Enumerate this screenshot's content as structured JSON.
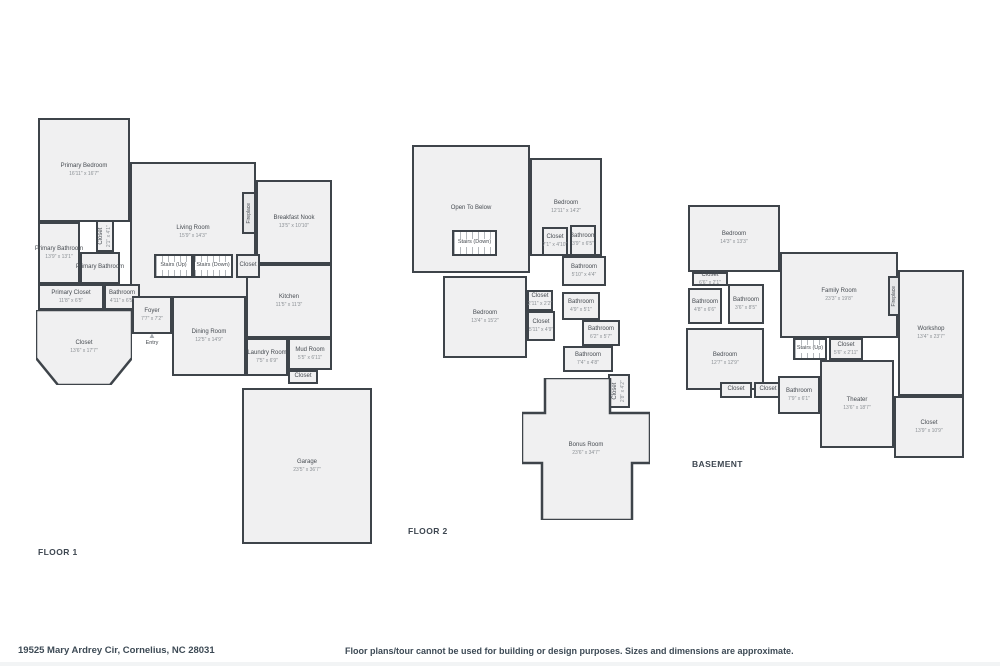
{
  "colors": {
    "wall": "#3e444a",
    "floor_fill": "#f0f0f1",
    "label_text": "#474c52",
    "dims_text": "#8b9095",
    "background": "#ffffff"
  },
  "footer": {
    "address": "19525 Mary Ardrey Cir, Cornelius, NC 28031",
    "disclaimer": "Floor plans/tour cannot be used for building or design purposes. Sizes and dimensions are approximate."
  },
  "floors": [
    {
      "id": "floor-1",
      "label": "FLOOR 1",
      "label_pos": {
        "x": 38,
        "y": 547
      },
      "rooms": [
        {
          "name": "Primary Bedroom",
          "dims": "16'11\" x 16'7\"",
          "x": 38,
          "y": 118,
          "w": 92,
          "h": 104
        },
        {
          "name": "Living Room",
          "dims": "15'9\" x 14'3\"",
          "x": 130,
          "y": 162,
          "w": 126,
          "h": 140
        },
        {
          "name": "Breakfast Nook",
          "dims": "13'5\" x 10'10\"",
          "x": 256,
          "y": 180,
          "w": 76,
          "h": 84
        },
        {
          "name": "Kitchen",
          "dims": "11'5\" x 11'3\"",
          "x": 246,
          "y": 264,
          "w": 86,
          "h": 74
        },
        {
          "name": "Fireplace",
          "type": "fireplace",
          "rotate": true,
          "x": 242,
          "y": 192,
          "w": 14,
          "h": 42
        },
        {
          "name": "Primary Bathroom",
          "dims": "13'9\" x 13'1\"",
          "x": 38,
          "y": 222,
          "w": 42,
          "h": 62
        },
        {
          "name": "Closet",
          "dims": "2'1\" x 4'1\"",
          "rotate": true,
          "x": 96,
          "y": 220,
          "w": 18,
          "h": 32
        },
        {
          "name": "Primary Bathroom",
          "x": 80,
          "y": 252,
          "w": 40,
          "h": 32
        },
        {
          "name": "Primary Closet",
          "dims": "11'8\" x 6'5\"",
          "x": 38,
          "y": 284,
          "w": 66,
          "h": 26
        },
        {
          "name": "Bathroom",
          "dims": "4'11\" x 6'5\"",
          "x": 104,
          "y": 284,
          "w": 36,
          "h": 26
        },
        {
          "name": "Closet",
          "dims": "13'6\" x 17'7\"",
          "x": 36,
          "y": 310,
          "w": 96,
          "h": 75,
          "points": [
            [
              0,
              0
            ],
            [
              96,
              0
            ],
            [
              96,
              48
            ],
            [
              74,
              75
            ],
            [
              22,
              75
            ],
            [
              0,
              48
            ]
          ]
        },
        {
          "name": "Foyer",
          "dims": "7'7\" x 7'2\"",
          "x": 132,
          "y": 296,
          "w": 40,
          "h": 38
        },
        {
          "name": "Entry",
          "type": "entry",
          "x": 138,
          "y": 330,
          "w": 28,
          "h": 20
        },
        {
          "name": "Stairs (Up)",
          "type": "stairs",
          "x": 154,
          "y": 254,
          "w": 39,
          "h": 24
        },
        {
          "name": "Stairs (Down)",
          "type": "stairs",
          "x": 193,
          "y": 254,
          "w": 40,
          "h": 24
        },
        {
          "name": "Closet",
          "x": 236,
          "y": 254,
          "w": 24,
          "h": 24
        },
        {
          "name": "Dining Room",
          "dims": "12'5\" x 14'9\"",
          "x": 172,
          "y": 296,
          "w": 74,
          "h": 80
        },
        {
          "name": "Laundry Room",
          "dims": "7'5\" x 6'9\"",
          "x": 246,
          "y": 338,
          "w": 42,
          "h": 38
        },
        {
          "name": "Mud Room",
          "dims": "5'5\" x 6'11\"",
          "x": 288,
          "y": 338,
          "w": 44,
          "h": 32
        },
        {
          "name": "Closet",
          "x": 288,
          "y": 370,
          "w": 30,
          "h": 14
        },
        {
          "name": "Garage",
          "dims": "23'5\" x 36'7\"",
          "x": 242,
          "y": 388,
          "w": 130,
          "h": 156
        }
      ]
    },
    {
      "id": "floor-2",
      "label": "FLOOR 2",
      "label_pos": {
        "x": 408,
        "y": 526
      },
      "rooms": [
        {
          "name": "Open To Below",
          "x": 412,
          "y": 145,
          "w": 118,
          "h": 128
        },
        {
          "name": "Stairs (Down)",
          "type": "stairs",
          "x": 452,
          "y": 230,
          "w": 45,
          "h": 26
        },
        {
          "name": "Bedroom",
          "dims": "12'11\" x 14'2\"",
          "x": 530,
          "y": 158,
          "w": 72,
          "h": 98
        },
        {
          "name": "Closet",
          "dims": "7'1\" x 4'10\"",
          "x": 542,
          "y": 227,
          "w": 26,
          "h": 29
        },
        {
          "name": "Bathroom",
          "dims": "3'9\" x 6'5\"",
          "x": 570,
          "y": 225,
          "w": 26,
          "h": 31
        },
        {
          "name": "Bathroom",
          "dims": "5'10\" x 4'4\"",
          "x": 562,
          "y": 256,
          "w": 44,
          "h": 30
        },
        {
          "name": "Bedroom",
          "dims": "13'4\" x 15'2\"",
          "x": 443,
          "y": 276,
          "w": 84,
          "h": 82
        },
        {
          "name": "Closet",
          "dims": "2'11\" x 2'2\"",
          "x": 527,
          "y": 290,
          "w": 26,
          "h": 21
        },
        {
          "name": "Closet",
          "dims": "5'11\" x 4'9\"",
          "x": 527,
          "y": 311,
          "w": 28,
          "h": 30
        },
        {
          "name": "Bathroom",
          "dims": "4'9\" x 5'1\"",
          "x": 562,
          "y": 292,
          "w": 38,
          "h": 28
        },
        {
          "name": "Bathroom",
          "dims": "6'2\" x 5'7\"",
          "x": 582,
          "y": 320,
          "w": 38,
          "h": 26
        },
        {
          "name": "Bathroom",
          "dims": "7'4\" x 4'8\"",
          "x": 563,
          "y": 346,
          "w": 50,
          "h": 26
        },
        {
          "name": "Closet",
          "dims": "2'8\" x 4'2\"",
          "rotate": true,
          "x": 608,
          "y": 374,
          "w": 22,
          "h": 34
        },
        {
          "name": "Bonus Room",
          "dims": "23'6\" x 34'7\"",
          "x": 522,
          "y": 378,
          "w": 128,
          "h": 142,
          "points": [
            [
              23,
              0
            ],
            [
              88,
              0
            ],
            [
              88,
              35
            ],
            [
              128,
              35
            ],
            [
              128,
              85
            ],
            [
              110,
              85
            ],
            [
              110,
              142
            ],
            [
              20,
              142
            ],
            [
              20,
              85
            ],
            [
              0,
              85
            ],
            [
              0,
              35
            ],
            [
              23,
              35
            ]
          ]
        }
      ]
    },
    {
      "id": "basement",
      "label": "BASEMENT",
      "label_pos": {
        "x": 692,
        "y": 459
      },
      "rooms": [
        {
          "name": "Bedroom",
          "dims": "14'3\" x 13'3\"",
          "x": 688,
          "y": 205,
          "w": 92,
          "h": 67
        },
        {
          "name": "Closet",
          "dims": "6'6\" x 2'1\"",
          "x": 692,
          "y": 272,
          "w": 36,
          "h": 14
        },
        {
          "name": "Bathroom",
          "dims": "4'8\" x 6'6\"",
          "x": 688,
          "y": 288,
          "w": 34,
          "h": 36
        },
        {
          "name": "Bathroom",
          "dims": "3'6\" x 8'5\"",
          "x": 728,
          "y": 284,
          "w": 36,
          "h": 40
        },
        {
          "name": "Family Room",
          "dims": "23'3\" x 19'8\"",
          "x": 780,
          "y": 252,
          "w": 118,
          "h": 86
        },
        {
          "name": "Fireplace",
          "type": "fireplace",
          "rotate": true,
          "x": 888,
          "y": 276,
          "w": 13,
          "h": 40
        },
        {
          "name": "Workshop",
          "dims": "13'4\" x 23'7\"",
          "x": 898,
          "y": 270,
          "w": 66,
          "h": 126
        },
        {
          "name": "Bedroom",
          "dims": "12'7\" x 12'9\"",
          "x": 686,
          "y": 328,
          "w": 78,
          "h": 62
        },
        {
          "name": "Closet",
          "x": 720,
          "y": 382,
          "w": 32,
          "h": 16
        },
        {
          "name": "Closet",
          "x": 754,
          "y": 382,
          "w": 28,
          "h": 16
        },
        {
          "name": "Stairs (Up)",
          "type": "stairs",
          "x": 793,
          "y": 338,
          "w": 34,
          "h": 22
        },
        {
          "name": "Closet",
          "dims": "5'6\" x 2'11\"",
          "x": 829,
          "y": 338,
          "w": 34,
          "h": 22
        },
        {
          "name": "Bathroom",
          "dims": "7'9\" x 6'1\"",
          "x": 778,
          "y": 376,
          "w": 42,
          "h": 38
        },
        {
          "name": "Theater",
          "dims": "13'6\" x 18'7\"",
          "x": 820,
          "y": 360,
          "w": 74,
          "h": 88
        },
        {
          "name": "Closet",
          "dims": "13'9\" x 10'9\"",
          "x": 894,
          "y": 396,
          "w": 70,
          "h": 62
        }
      ]
    }
  ]
}
